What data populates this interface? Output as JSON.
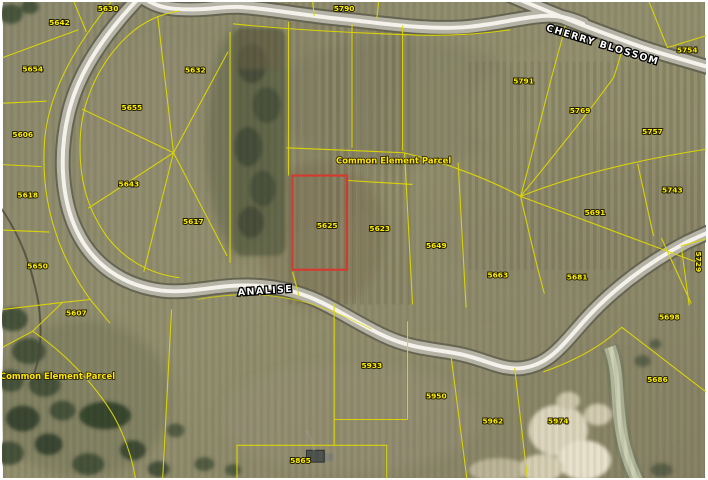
{
  "map": {
    "type": "gis-parcel-aerial-view",
    "streets": [
      {
        "name": "CHERRY BLOSSOM",
        "x": 604,
        "y": 46,
        "angle": 17
      },
      {
        "name": "ANALISE",
        "x": 265,
        "y": 294,
        "angle": -4
      }
    ],
    "area_labels": [
      {
        "text": "Common Element Parcel",
        "x": 394,
        "y": 163
      },
      {
        "text": "Common Element Parcel",
        "x": 55,
        "y": 380
      }
    ],
    "parcel_labels": [
      {
        "text": "5630",
        "x": 106,
        "y": 9
      },
      {
        "text": "5790",
        "x": 344,
        "y": 9
      },
      {
        "text": "5642",
        "x": 57,
        "y": 23
      },
      {
        "text": "5754",
        "x": 690,
        "y": 51
      },
      {
        "text": "5654",
        "x": 30,
        "y": 70
      },
      {
        "text": "5632",
        "x": 194,
        "y": 71
      },
      {
        "text": "5791",
        "x": 525,
        "y": 82
      },
      {
        "text": "5655",
        "x": 130,
        "y": 109
      },
      {
        "text": "5769",
        "x": 582,
        "y": 112
      },
      {
        "text": "5757",
        "x": 655,
        "y": 133
      },
      {
        "text": "5606",
        "x": 20,
        "y": 136
      },
      {
        "text": "5643",
        "x": 127,
        "y": 186
      },
      {
        "text": "5618",
        "x": 25,
        "y": 197
      },
      {
        "text": "5743",
        "x": 675,
        "y": 192
      },
      {
        "text": "5691",
        "x": 597,
        "y": 215
      },
      {
        "text": "5617",
        "x": 192,
        "y": 224
      },
      {
        "text": "5625",
        "x": 327,
        "y": 228
      },
      {
        "text": "5623",
        "x": 380,
        "y": 231
      },
      {
        "text": "5649",
        "x": 437,
        "y": 248
      },
      {
        "text": "5650",
        "x": 35,
        "y": 269
      },
      {
        "text": "5663",
        "x": 499,
        "y": 278
      },
      {
        "text": "5681",
        "x": 579,
        "y": 280
      },
      {
        "text": "5729",
        "x": 699,
        "y": 262,
        "vertical": true
      },
      {
        "text": "5607",
        "x": 74,
        "y": 316
      },
      {
        "text": "5698",
        "x": 672,
        "y": 320
      },
      {
        "text": "5933",
        "x": 372,
        "y": 369
      },
      {
        "text": "5686",
        "x": 660,
        "y": 383
      },
      {
        "text": "5950",
        "x": 437,
        "y": 400
      },
      {
        "text": "5962",
        "x": 494,
        "y": 425
      },
      {
        "text": "5974",
        "x": 560,
        "y": 425
      },
      {
        "text": "5865",
        "x": 300,
        "y": 465
      }
    ],
    "selected_parcel": {
      "number": "5625",
      "x": 292,
      "y": 175,
      "width": 55,
      "height": 95
    },
    "colors": {
      "parcel_line": "#ded800",
      "label_text": "#ffee00",
      "street_text": "#ffffff",
      "selected_outline": "#d23b2f",
      "road_center": "#f4f2ea"
    }
  }
}
